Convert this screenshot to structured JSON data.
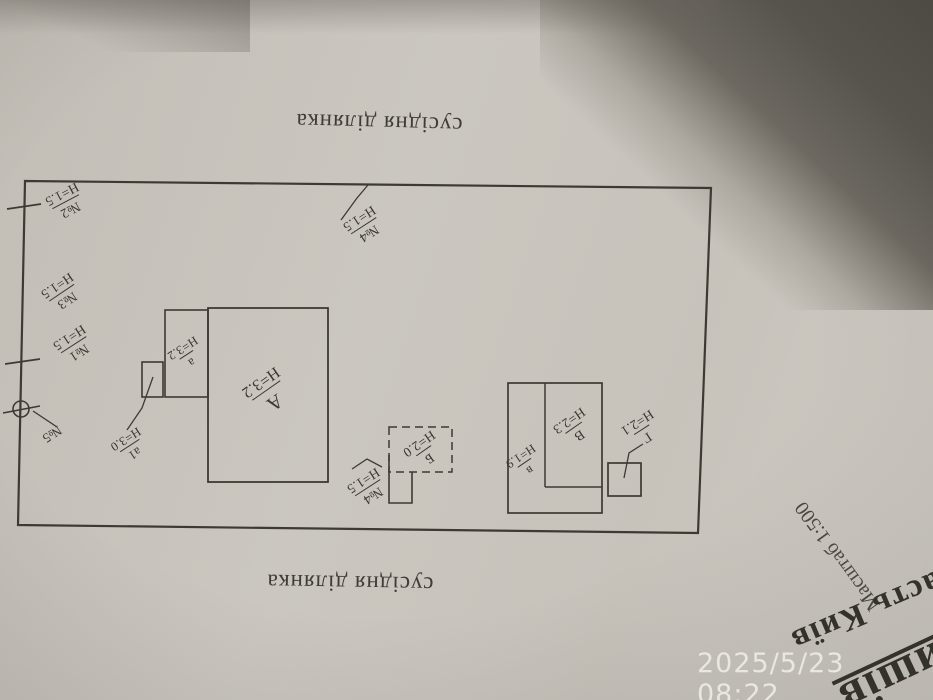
{
  "photo": {
    "timestamp": "2025/5/23 08:22"
  },
  "plan": {
    "neighbor_top": "сусідня ділянка",
    "neighbor_bottom": "сусідня ділянка",
    "fence_labels": [
      {
        "number": "№2",
        "height": "Н=1.5"
      },
      {
        "number": "№3",
        "height": "Н=1.5"
      },
      {
        "number": "№1",
        "height": "Н=1.5"
      },
      {
        "number": "№4",
        "height": "Н=1.5"
      },
      {
        "number": "№4",
        "height": "Н=1.5"
      },
      {
        "number": "№5"
      }
    ],
    "buildings": [
      {
        "letter": "А",
        "height": "Н=3.2"
      },
      {
        "letter": "а",
        "height": "Н=3.2"
      },
      {
        "letter": "а1",
        "height": "Н=3.0"
      },
      {
        "letter": "Б",
        "height": "Н=2.0"
      },
      {
        "letter": "В",
        "height": "Н=2.3"
      },
      {
        "letter": "в",
        "height": "Н=1.9"
      },
      {
        "letter": "Г",
        "height": "Н=2.1"
      }
    ]
  },
  "title_block": {
    "scale": "Масштаб 1:500",
    "region_line": "Область Київ",
    "settlement_fragment": "ришів"
  },
  "colors": {
    "paper": "#cac6be",
    "ink": "#3d3a33",
    "background_dark": "#53504a",
    "timestamp_text": "#eceae5"
  }
}
